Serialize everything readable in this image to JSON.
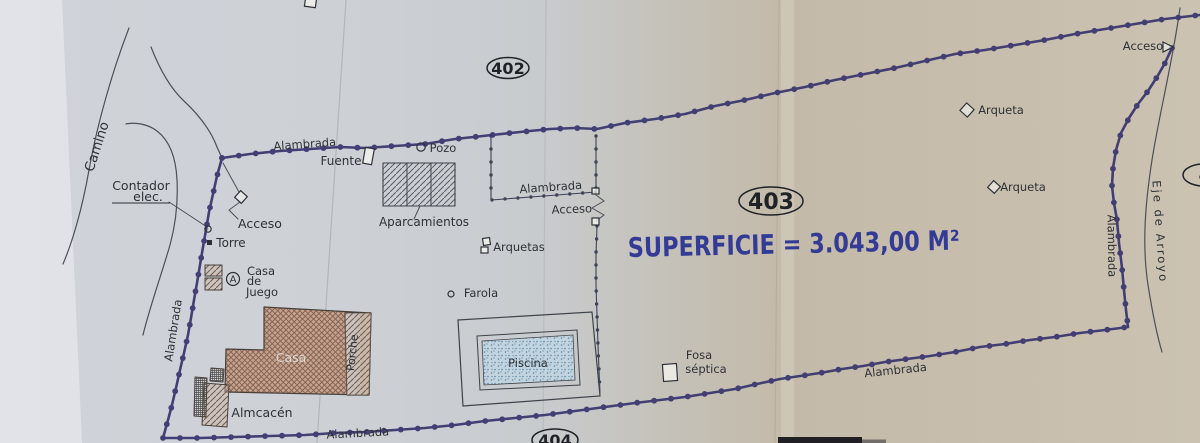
{
  "plan": {
    "colors": {
      "ink": "#2e3237",
      "fence": "#3b3870",
      "thin_fence": "#3f4356",
      "line": "#4b5058",
      "superficie_blue": "#333b95",
      "parcel_ink": "#1f2226",
      "casa_base": "#c4a28e",
      "casa_hatch": "#82604f",
      "pink_hatch_bg": "#cbb3a4",
      "pink_hatch_line": "#6e5c52",
      "gray_hatch": "#585e66",
      "pool_water": "#c2d4df",
      "pool_dots": "#5d86a4",
      "casa_label": "#ddd6cf"
    },
    "superficie": {
      "id": "superficie",
      "text": "SUPERFICIE = 3.043,00 M²",
      "x": 628,
      "y": 257,
      "size": 27,
      "rot": -1.3,
      "tl": 332
    },
    "parcels": [
      {
        "id": "parcel-402",
        "label": "402",
        "cx": 508,
        "cy": 68,
        "rx": 21,
        "ry": 10.5,
        "size": 16
      },
      {
        "id": "parcel-403",
        "label": "403",
        "cx": 771,
        "cy": 201,
        "rx": 32,
        "ry": 14,
        "size": 22
      },
      {
        "id": "parcel-404",
        "label": "404",
        "cx": 555,
        "cy": 440,
        "rx": 23,
        "ry": 11,
        "size": 16
      },
      {
        "id": "parcel-right-partial",
        "label": "4",
        "cx": 1204,
        "cy": 175,
        "rx": 21,
        "ry": 11,
        "size": 15
      }
    ],
    "labels": [
      {
        "id": "camino",
        "text": "Camino",
        "x": 101,
        "y": 148,
        "rot": -72,
        "size": 13.5
      },
      {
        "id": "contador-1",
        "text": "Contador",
        "x": 141,
        "y": 190,
        "size": 12.5
      },
      {
        "id": "contador-2",
        "text": "elec.",
        "x": 148,
        "y": 201,
        "size": 12.5
      },
      {
        "id": "acceso-west",
        "text": "Acceso",
        "x": 260,
        "y": 228,
        "size": 12.5
      },
      {
        "id": "torre",
        "text": "Torre",
        "x": 231,
        "y": 247,
        "size": 12
      },
      {
        "id": "casa-de-juego-1",
        "text": "Casa",
        "x": 261,
        "y": 275,
        "size": 11.5
      },
      {
        "id": "casa-de-juego-2",
        "text": "de",
        "x": 254,
        "y": 285,
        "size": 11.5
      },
      {
        "id": "casa-de-juego-3",
        "text": "Juego",
        "x": 262,
        "y": 296,
        "size": 11.5
      },
      {
        "id": "alambrada-nw",
        "text": "Alambrada",
        "x": 305,
        "y": 148,
        "rot": -4,
        "size": 11.5
      },
      {
        "id": "fuente",
        "text": "Fuente",
        "x": 341,
        "y": 165,
        "size": 12
      },
      {
        "id": "pozo",
        "text": "Pozo",
        "x": 443,
        "y": 152,
        "size": 11.5
      },
      {
        "id": "aparcamientos",
        "text": "Aparcamientos",
        "x": 424,
        "y": 226,
        "size": 12
      },
      {
        "id": "alambrada-inner",
        "text": "Alambrada",
        "x": 551,
        "y": 191,
        "rot": -4,
        "size": 11.5
      },
      {
        "id": "acceso-inner",
        "text": "Acceso",
        "x": 572,
        "y": 213,
        "rot": -2,
        "size": 11.5
      },
      {
        "id": "arquetas",
        "text": "Arquetas",
        "x": 519,
        "y": 251,
        "size": 11.5
      },
      {
        "id": "farola",
        "text": "Farola",
        "x": 481,
        "y": 297,
        "size": 11.5
      },
      {
        "id": "piscina",
        "text": "Piscina",
        "x": 528,
        "y": 367,
        "size": 11.5
      },
      {
        "id": "alambrada-west",
        "text": "Alambrada",
        "x": 177,
        "y": 331,
        "rot": -81,
        "size": 11.5
      },
      {
        "id": "alambrada-s1",
        "text": "Alambrada",
        "x": 358,
        "y": 437,
        "rot": -3,
        "size": 11.5
      },
      {
        "id": "alambrada-s2",
        "text": "Alambrada",
        "x": 896,
        "y": 374,
        "rot": -6,
        "size": 11.5
      },
      {
        "id": "fosa-1",
        "text": "Fosa",
        "x": 699,
        "y": 359,
        "size": 11.5
      },
      {
        "id": "fosa-2",
        "text": "séptica",
        "x": 706,
        "y": 373,
        "size": 11.5
      },
      {
        "id": "alambrada-east",
        "text": "Alambrada",
        "x": 1108,
        "y": 246,
        "rot": 89,
        "size": 11.5
      },
      {
        "id": "arqueta-ne",
        "text": "Arqueta",
        "x": 1001,
        "y": 114,
        "size": 11.5
      },
      {
        "id": "arqueta-e",
        "text": "Arqueta",
        "x": 1023,
        "y": 191,
        "size": 11.5
      },
      {
        "id": "acceso-ne",
        "text": "Acceso",
        "x": 1143,
        "y": 50,
        "size": 11.5
      },
      {
        "id": "eje-arroyo",
        "text": "Eje de Arroyo",
        "x": 1156,
        "y": 232,
        "rot": 86,
        "size": 11.5,
        "ls": 2
      },
      {
        "id": "casa-label",
        "text": "Casa",
        "x": 291,
        "y": 362,
        "size": 12.5,
        "color": "#ddd6cf"
      },
      {
        "id": "porche-label",
        "text": "Porche",
        "x": 356,
        "y": 353,
        "rot": -84,
        "size": 11
      },
      {
        "id": "almacen",
        "text": "Almcacén",
        "x": 262,
        "y": 417,
        "size": 12.5
      }
    ],
    "geometry": {
      "main_fence": [
        [
          [
            222,
            158
          ],
          [
            250,
            154
          ],
          [
            280,
            151
          ],
          [
            310,
            149
          ],
          [
            340,
            147
          ],
          [
            365,
            148
          ],
          [
            395,
            146
          ],
          [
            425,
            144
          ],
          [
            455,
            139
          ],
          [
            492,
            135
          ],
          [
            520,
            132
          ],
          [
            550,
            129
          ],
          [
            575,
            128
          ],
          [
            597,
            129
          ],
          [
            625,
            123
          ],
          [
            655,
            119
          ],
          [
            685,
            114
          ],
          [
            715,
            106
          ],
          [
            745,
            100
          ],
          [
            775,
            93
          ],
          [
            805,
            87
          ],
          [
            835,
            80
          ],
          [
            865,
            74
          ],
          [
            895,
            68
          ],
          [
            925,
            61
          ],
          [
            955,
            54
          ],
          [
            985,
            50
          ],
          [
            1015,
            45
          ],
          [
            1045,
            40
          ],
          [
            1075,
            34
          ],
          [
            1105,
            29
          ],
          [
            1135,
            24
          ],
          [
            1165,
            19
          ],
          [
            1200,
            15
          ]
        ],
        [
          [
            1172,
            48
          ],
          [
            1165,
            63
          ],
          [
            1157,
            77
          ],
          [
            1148,
            91
          ],
          [
            1138,
            104
          ],
          [
            1129,
            118
          ],
          [
            1121,
            133
          ],
          [
            1116,
            150
          ],
          [
            1113,
            168
          ],
          [
            1112,
            186
          ],
          [
            1114,
            203
          ],
          [
            1117,
            220
          ],
          [
            1119,
            243
          ],
          [
            1122,
            268
          ],
          [
            1124,
            290
          ],
          [
            1126,
            310
          ],
          [
            1128,
            327
          ]
        ],
        [
          [
            222,
            158
          ],
          [
            217,
            176
          ],
          [
            213,
            194
          ],
          [
            209,
            212
          ],
          [
            206,
            230
          ],
          [
            203,
            247
          ],
          [
            200,
            265
          ],
          [
            197,
            283
          ],
          [
            194,
            300
          ],
          [
            191,
            318
          ],
          [
            188,
            335
          ],
          [
            184,
            353
          ],
          [
            180,
            370
          ],
          [
            176,
            388
          ],
          [
            172,
            405
          ],
          [
            168,
            420
          ],
          [
            163,
            438
          ]
        ],
        [
          [
            163,
            438
          ],
          [
            200,
            438
          ],
          [
            235,
            437
          ],
          [
            270,
            436
          ],
          [
            305,
            435
          ],
          [
            335,
            433
          ],
          [
            365,
            432
          ],
          [
            395,
            430
          ],
          [
            425,
            428
          ],
          [
            455,
            425
          ],
          [
            485,
            421
          ],
          [
            515,
            418
          ],
          [
            545,
            415
          ],
          [
            575,
            411
          ],
          [
            605,
            407
          ],
          [
            635,
            403
          ],
          [
            660,
            400
          ],
          [
            685,
            397
          ],
          [
            710,
            393
          ],
          [
            735,
            389
          ],
          [
            757,
            384
          ],
          [
            780,
            379
          ],
          [
            800,
            376
          ],
          [
            820,
            373
          ],
          [
            842,
            369
          ],
          [
            863,
            366
          ],
          [
            885,
            362
          ],
          [
            907,
            359
          ],
          [
            930,
            356
          ],
          [
            955,
            352
          ],
          [
            980,
            347
          ],
          [
            1005,
            344
          ],
          [
            1030,
            340
          ],
          [
            1055,
            337
          ],
          [
            1080,
            333
          ],
          [
            1105,
            330
          ],
          [
            1128,
            327
          ]
        ]
      ],
      "inner_fences": [
        [
          [
            491,
            136
          ],
          [
            491,
            200
          ],
          [
            544,
            196
          ],
          [
            596,
            192
          ]
        ],
        [
          [
            596,
            136
          ],
          [
            596,
            190
          ]
        ],
        [
          [
            597,
            226
          ],
          [
            596,
            255
          ],
          [
            596,
            285
          ],
          [
            597,
            315
          ],
          [
            598,
            345
          ],
          [
            599,
            370
          ],
          [
            600,
            393
          ]
        ]
      ],
      "roads": [
        "M129,28 C112,72 97,125 89,170 C82,210 72,243 63,264",
        "M151,47 C160,70 171,89 184,101 C199,115 211,131 217,147 L222,158",
        "M143,335 C150,306 162,273 170,245 C176,223 178,200 177,180 C176,158 170,141 157,131 C148,124 135,122 126,124"
      ],
      "arroyo": "M1180,8 C1173,60 1160,110 1152,160 C1145,205 1142,245 1148,285 C1152,310 1156,332 1162,352",
      "leaders": [
        [
          [
            169,
            202
          ],
          [
            207,
            227
          ]
        ],
        [
          [
            223,
            163
          ],
          [
            239,
            192
          ]
        ],
        [
          [
            420,
            206
          ],
          [
            414,
            219
          ]
        ]
      ],
      "underline": [
        [
          112,
          203
        ],
        [
          170,
          203
        ]
      ],
      "zigzags": [
        "M596,195 L604,201 L592,208 L604,215 L596,221",
        "M240,202 L229,210 L238,219"
      ],
      "creases": [
        {
          "x1": 346,
          "y1": 0,
          "x2": 317,
          "y2": 443,
          "o": 0.18
        },
        {
          "x1": 546,
          "y1": 0,
          "x2": 543,
          "y2": 443,
          "o": 0.1
        },
        {
          "x1": 779,
          "y1": 0,
          "x2": 775,
          "y2": 443,
          "o": 0.1
        }
      ],
      "buildings": {
        "casa": [
          [
            264,
            307
          ],
          [
            371,
            313
          ],
          [
            369,
            395
          ],
          [
            225,
            392
          ],
          [
            226,
            349
          ],
          [
            264,
            350
          ]
        ],
        "porche": [
          [
            345,
            313
          ],
          [
            371,
            313
          ],
          [
            369,
            395
          ],
          [
            347,
            395
          ]
        ],
        "almacen_diag": [
          [
            204,
            383
          ],
          [
            229,
            385
          ],
          [
            227,
            427
          ],
          [
            202,
            425
          ]
        ],
        "almacen_grid": [
          [
            195,
            377
          ],
          [
            207,
            378
          ],
          [
            206,
            417
          ],
          [
            194,
            416
          ]
        ],
        "step_grid": [
          [
            211,
            368
          ],
          [
            224,
            369
          ],
          [
            223,
            382
          ],
          [
            210,
            381
          ]
        ],
        "cdj1": {
          "x": 205,
          "y": 265,
          "w": 17,
          "h": 11
        },
        "cdj2": {
          "x": 205,
          "y": 278,
          "w": 17,
          "h": 12
        },
        "aparcamientos": {
          "x": 383,
          "y": 163,
          "w": 72,
          "h": 43,
          "dividers": [
            407,
            431
          ]
        }
      },
      "pool": {
        "outer": [
          [
            458,
            320
          ],
          [
            592,
            312
          ],
          [
            600,
            396
          ],
          [
            463,
            406
          ]
        ],
        "mid": [
          [
            477,
            336
          ],
          [
            577,
            330
          ],
          [
            580,
            385
          ],
          [
            480,
            390
          ]
        ],
        "inner": [
          [
            482,
            341
          ],
          [
            573,
            335
          ],
          [
            575,
            380
          ],
          [
            484,
            385
          ]
        ]
      },
      "symbols": {
        "circles": [
          {
            "id": "pozo-circle",
            "x": 421,
            "y": 147,
            "r": 4.2
          },
          {
            "id": "farola-circle",
            "x": 451,
            "y": 294,
            "r": 3
          },
          {
            "id": "contador-meter",
            "x": 208,
            "y": 229,
            "r": 3.2
          }
        ],
        "boxes": [
          {
            "id": "fuente-box",
            "x": 364,
            "y": 148,
            "w": 9,
            "h": 16,
            "rot": 10
          },
          {
            "id": "fosa-septica-box",
            "x": 663,
            "y": 364,
            "w": 14,
            "h": 17,
            "rot": -4
          },
          {
            "id": "arqueta-box-1",
            "x": 483,
            "y": 238,
            "w": 7,
            "h": 7,
            "rot": -8
          },
          {
            "id": "arqueta-box-2",
            "x": 481,
            "y": 247,
            "w": 7,
            "h": 6,
            "rot": 0
          },
          {
            "id": "gate-post-1",
            "x": 592,
            "y": 188,
            "w": 7,
            "h": 6,
            "rot": 0
          },
          {
            "id": "gate-post-2",
            "x": 592,
            "y": 218,
            "w": 7,
            "h": 7,
            "rot": 0
          },
          {
            "id": "top-edge-box",
            "x": 305,
            "y": -2,
            "w": 11,
            "h": 9,
            "rot": 8
          }
        ],
        "diamonds": [
          {
            "id": "acceso-west-diamond",
            "x": 241,
            "y": 197,
            "s": 9
          },
          {
            "id": "arqueta-ne-diamond",
            "x": 967,
            "y": 110,
            "s": 10
          },
          {
            "id": "arqueta-e-diamond",
            "x": 994,
            "y": 187,
            "s": 9
          }
        ],
        "torre_square": {
          "x": 207,
          "y": 240,
          "s": 5
        },
        "acceso_arrow": [
          [
            1163,
            42
          ],
          [
            1173,
            47
          ],
          [
            1163,
            52
          ]
        ],
        "circled_a": {
          "x": 233,
          "y": 279,
          "r": 6.5,
          "letter": "A"
        }
      },
      "dark_bar": {
        "x": 778,
        "y": 437,
        "w": 84,
        "h": 6,
        "fade_w": 26
      }
    }
  }
}
